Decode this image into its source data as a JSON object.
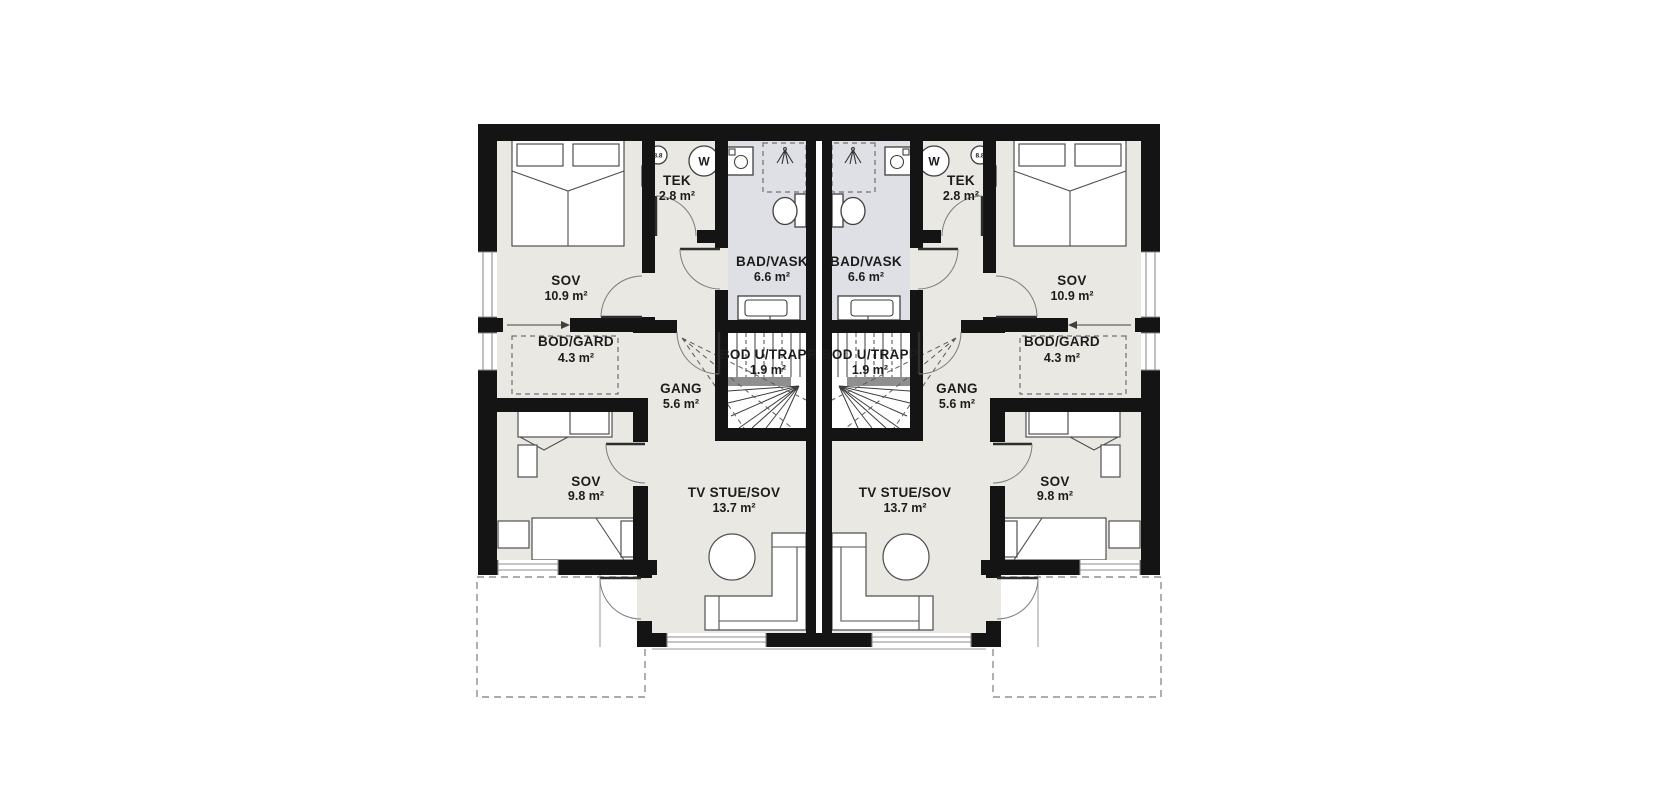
{
  "plan": {
    "rooms": {
      "sov_main": {
        "name": "SOV",
        "area": "10.9 m²"
      },
      "tek": {
        "name": "TEK",
        "area": "2.8 m²"
      },
      "bad_vask": {
        "name": "BAD/VASK",
        "area": "6.6 m²"
      },
      "bod_gard": {
        "name": "BOD/GARD",
        "area": "4.3 m²"
      },
      "gang": {
        "name": "GANG",
        "area": "5.6 m²"
      },
      "bod_u_trapp": {
        "name": "BOD U/TRAPP",
        "area": "1.9 m²"
      },
      "sov_small": {
        "name": "SOV",
        "area": "9.8 m²"
      },
      "tv_stue": {
        "name": "TV STUE/SOV",
        "area": "13.7 m²"
      }
    },
    "markers": {
      "vent_circle": "8.8",
      "water_heater": "W"
    },
    "colors": {
      "wall": "#141414",
      "room_fill": "#e9e8e2",
      "bath_fill": "#dfe0e5",
      "background": "#ffffff"
    }
  }
}
